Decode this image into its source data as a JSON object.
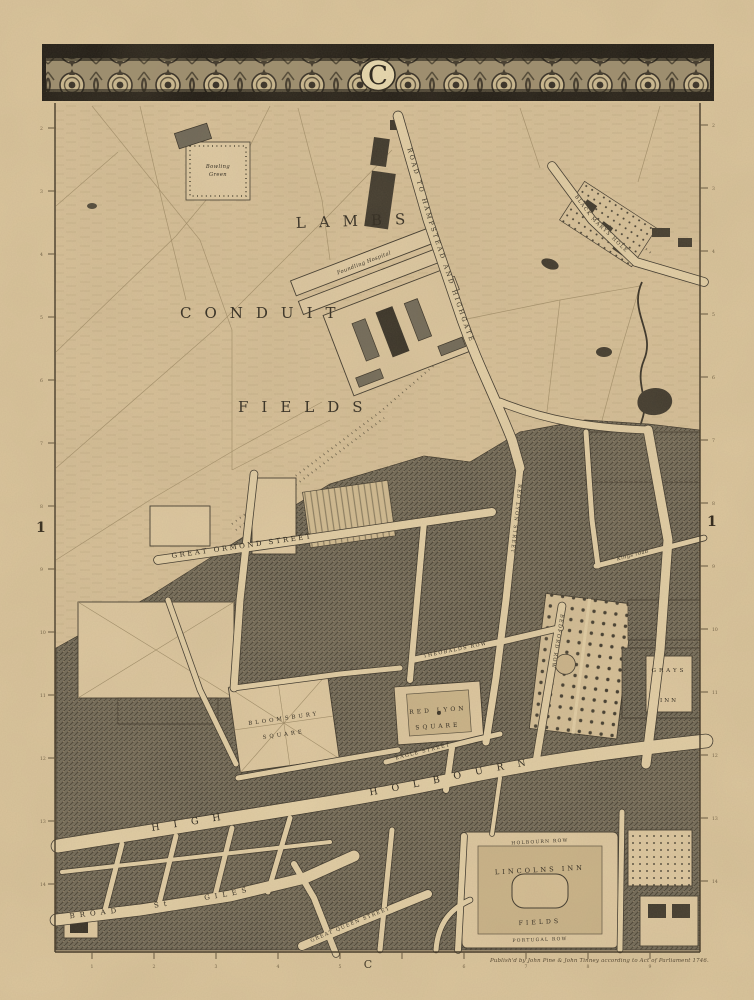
{
  "sheet": {
    "top_letter": "C",
    "bottom_letter": "C",
    "left_grid_number": "1",
    "right_grid_number": "1",
    "imprint": "Publish'd by John Pine & John Tinney according to Act of Parliament 1746."
  },
  "labels": {
    "lambs": "LAMBS",
    "conduit": "CONDUIT",
    "fields": "FIELDS",
    "road_hampstead": "ROAD TO HAMPSTEAD AND HIGHGATE",
    "black_marys_hole": "BLACK MARYS HOLE",
    "bowling_green_line1": "Bowling",
    "bowling_green_line2": "Green",
    "foundling_hospital": "Foundling Hospital",
    "great_ormond_street": "GREAT ORMOND STREET",
    "red_lyon_street": "RED LYON STREET",
    "theobalds_row": "THEOBALDS ROW",
    "bedford_row": "BEDFORD ROW",
    "eagle_street": "EAGLE STREET",
    "kings_road": "Kings road",
    "high_holbourn": "HIGH HOLBOURN",
    "broad_st_giles": "BROAD St GILES",
    "great_queen_street": "GREAT QUEEN STREET",
    "red_lyon_square_line1": "RED LYON",
    "red_lyon_square_line2": "SQUARE",
    "bloomsbury_square_line1": "BLOOMSBURY",
    "bloomsbury_square_line2": "SQUARE",
    "lincolns_inn": "LINCOLNS INN",
    "lincolns_inn_fields": "FIELDS",
    "holbourn_row": "HOLBOURN ROW",
    "portugal_row": "PORTUGAL ROW",
    "grays": "GRAYS",
    "inn": "INN"
  },
  "rulers": {
    "left": [
      "2",
      "3",
      "4",
      "5",
      "6",
      "7",
      "8",
      "9",
      "10",
      "11",
      "12",
      "13",
      "14"
    ],
    "right": [
      "2",
      "3",
      "4",
      "5",
      "6",
      "7",
      "8",
      "9",
      "10",
      "11",
      "12",
      "13",
      "14"
    ],
    "bottom": [
      "1",
      "2",
      "3",
      "4",
      "5",
      "",
      "6",
      "7",
      "8",
      "9"
    ]
  }
}
